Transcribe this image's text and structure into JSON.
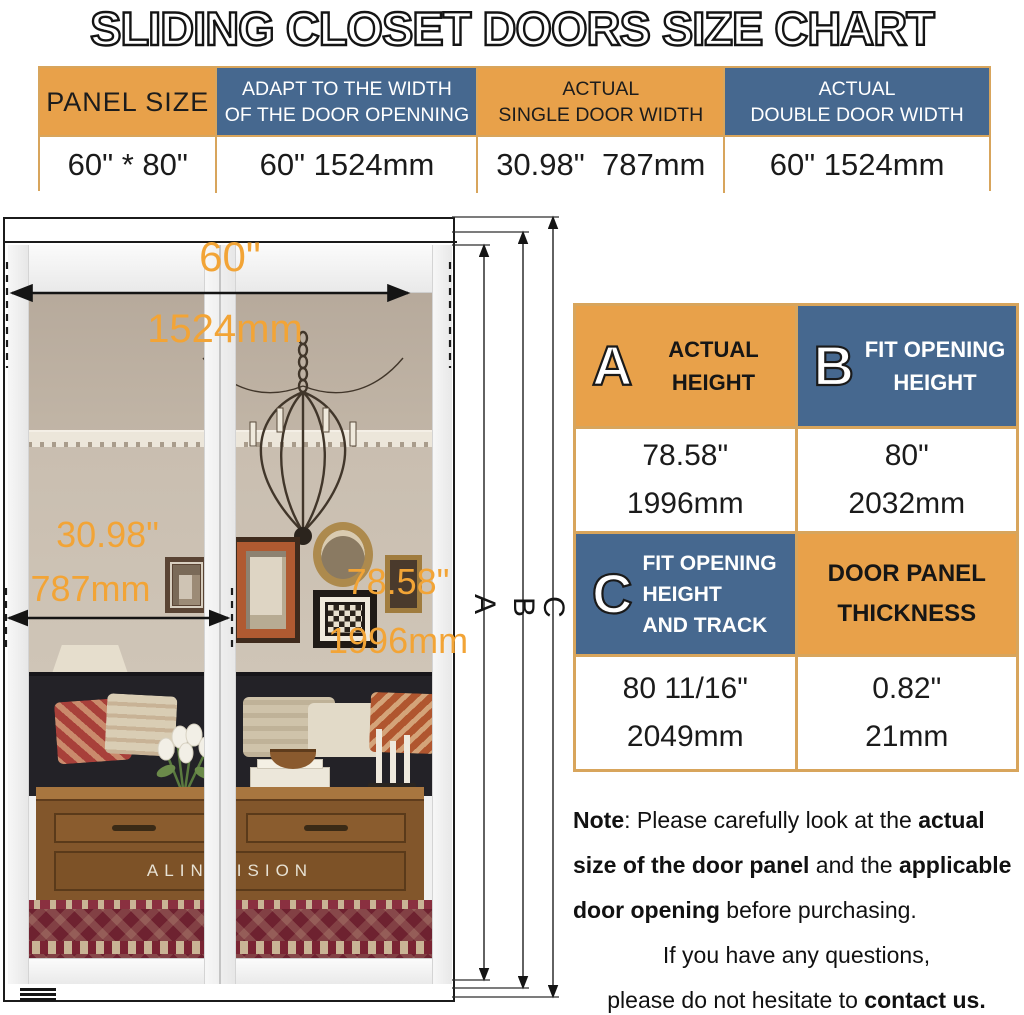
{
  "title": "SLIDING CLOSET DOORS SIZE CHART",
  "colors": {
    "header_orange": "#E8A14A",
    "header_blue": "#46688F",
    "table_border_tan": "#D8A55C",
    "dimension_text_orange": "#F2A436"
  },
  "top_table": {
    "columns": [
      {
        "h1": "PANEL SIZE",
        "h2": "",
        "value": "60\" * 80\"",
        "style": "orange"
      },
      {
        "h1": "ADAPT TO THE WIDTH",
        "h2": "OF THE DOOR OPENNING",
        "value": "60\" 1524mm",
        "style": "blue"
      },
      {
        "h1": "ACTUAL",
        "h2": "SINGLE DOOR WIDTH",
        "value": "30.98\"  787mm",
        "style": "orange"
      },
      {
        "h1": "ACTUAL",
        "h2": "DOUBLE DOOR WIDTH",
        "value": "60\" 1524mm",
        "style": "blue"
      }
    ]
  },
  "figure": {
    "labels": {
      "width_in": "60\"",
      "width_mm": "1524mm",
      "single_in": "30.98\"",
      "single_mm": "787mm",
      "height_in": "78.58\"",
      "height_mm": "1996mm",
      "line_a": "A",
      "line_b": "B",
      "line_c": "C",
      "brand": "ALIN VISION"
    }
  },
  "spec_table": {
    "a": {
      "letter": "A",
      "l1": "ACTUAL",
      "l2": "HEIGHT"
    },
    "b": {
      "letter": "B",
      "l1": "FIT OPENING",
      "l2": "HEIGHT"
    },
    "c": {
      "letter": "C",
      "l1": "FIT OPENING",
      "l2": "HEIGHT",
      "l3": "AND TRACK"
    },
    "t": {
      "l1": "DOOR PANEL",
      "l2": "THICKNESS"
    },
    "a_val": {
      "inch": "78.58\"",
      "mm": "1996mm"
    },
    "b_val": {
      "inch": "80\"",
      "mm": "2032mm"
    },
    "c_val": {
      "inch": "80 11/16\"",
      "mm": "2049mm"
    },
    "t_val": {
      "inch": "0.82\"",
      "mm": "21mm"
    }
  },
  "note": {
    "l1a": "Note",
    "l1b": ": Please carefully look at the ",
    "l1c": "actual",
    "l2a": "size of the door panel",
    "l2b": " and the ",
    "l2c": "applicable",
    "l3a": "door opening",
    "l3b": " before purchasing.",
    "l4": "If you have any questions,",
    "l5a": "please do not hesitate to ",
    "l5b": "contact us."
  }
}
